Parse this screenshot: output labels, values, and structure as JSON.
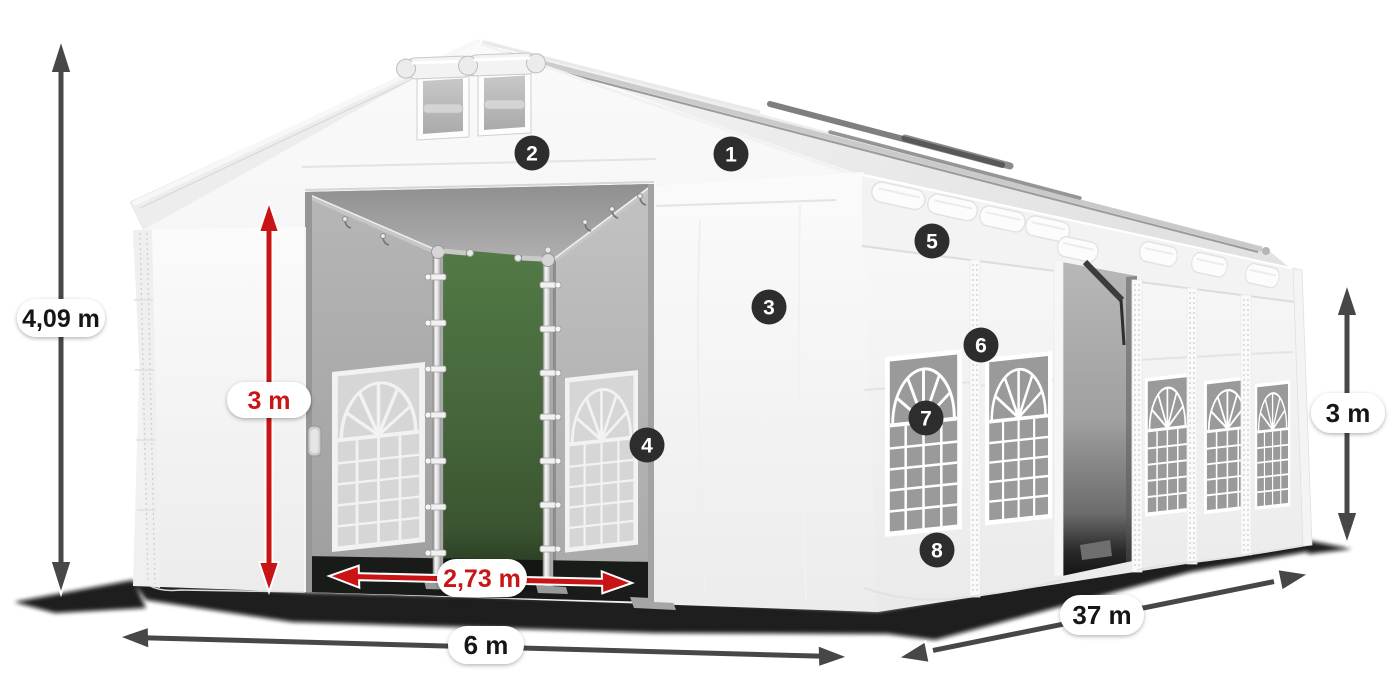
{
  "meta": {
    "description": "3D product diagram of a white 6 m x 37 m storage marquee tent with open front doors, numbered feature callouts and dimension arrows",
    "background": "#ffffff"
  },
  "dimension_labels": {
    "overall_height": "4,09 m",
    "entrance_height": "3 m",
    "entrance_width": "2,73 m",
    "front_width": "6 m",
    "side_length": "37 m",
    "wall_height": "3 m"
  },
  "callouts": [
    {
      "number": "1"
    },
    {
      "number": "2"
    },
    {
      "number": "3"
    },
    {
      "number": "4"
    },
    {
      "number": "5"
    },
    {
      "number": "6"
    },
    {
      "number": "7"
    },
    {
      "number": "8"
    }
  ],
  "colors": {
    "dimension_arrow": "#474747",
    "highlight_arrow": "#c81414",
    "pill_background": "#ffffff",
    "pill_text_dark": "#161616",
    "pill_text_red": "#c81414",
    "callout_badge": "#2d2d2d",
    "callout_text": "#ffffff",
    "tent_canvas": "#f6f6f6",
    "interior_opening_green": "#48663c",
    "ground_shadow": "#0a0a0a"
  }
}
